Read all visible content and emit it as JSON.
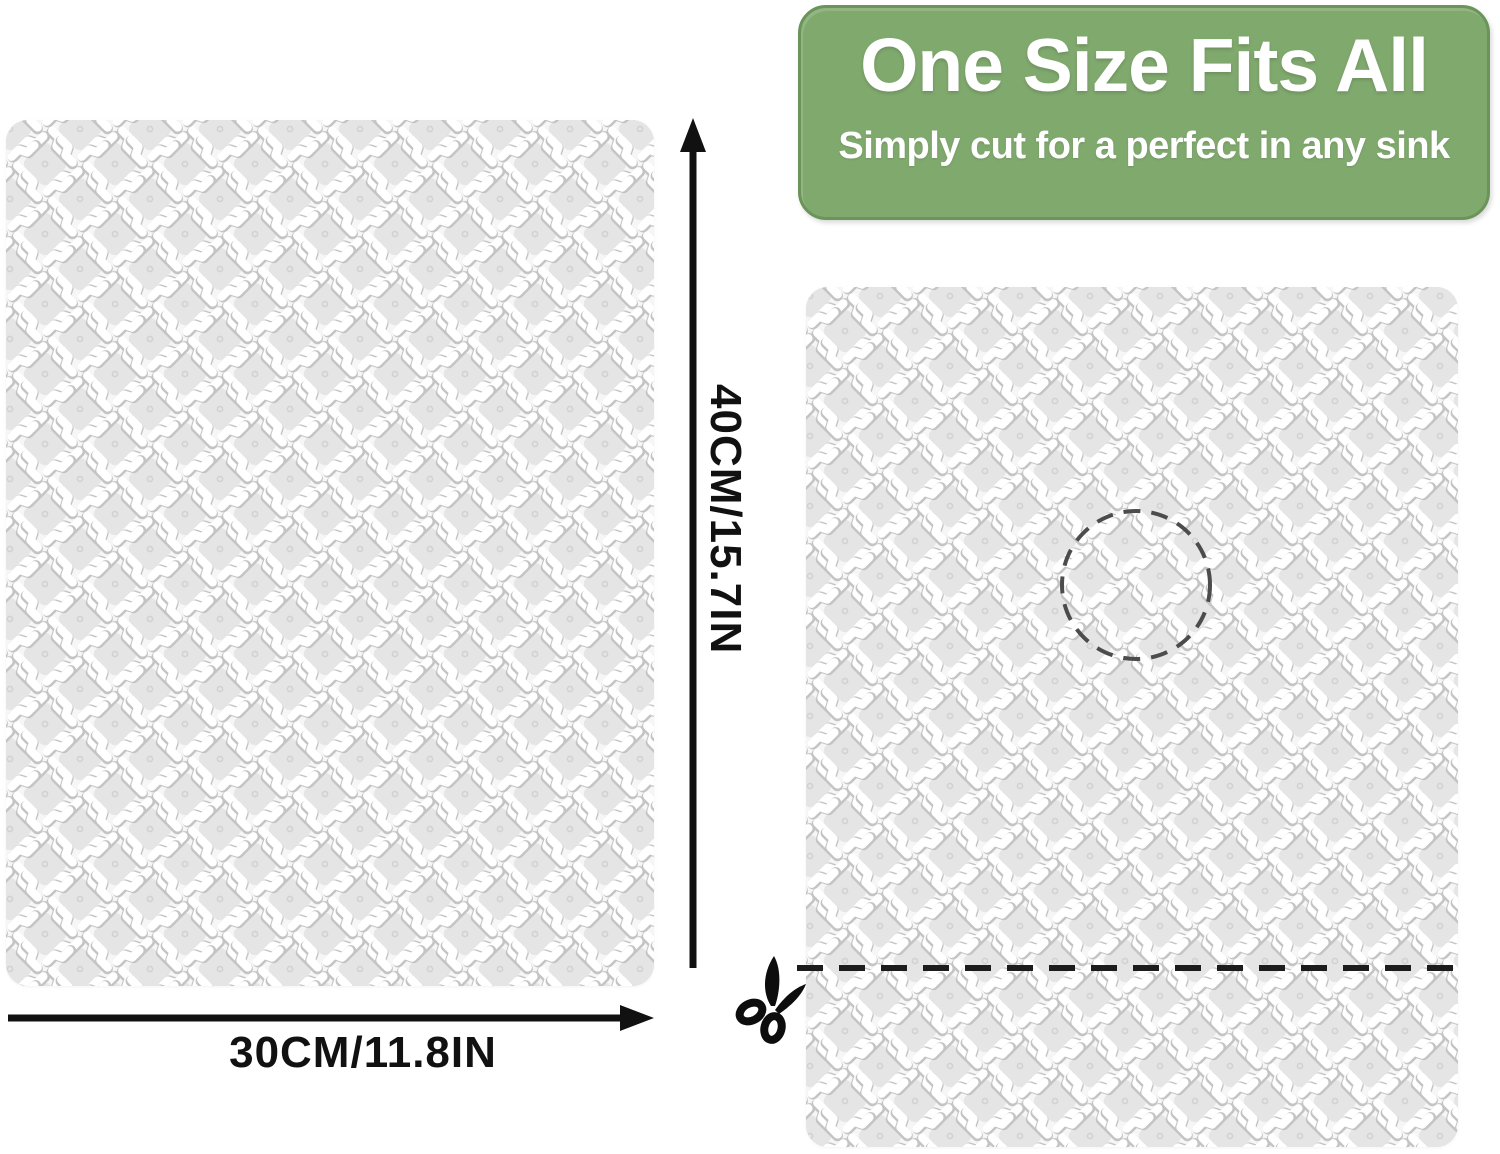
{
  "banner": {
    "title": "One Size Fits All",
    "subtitle": "Simply cut for a perfect in any sink"
  },
  "dimensions": {
    "height_label": "40CM/15.7IN",
    "width_label": "30CM/11.8IN"
  },
  "icons": {
    "scissors": "scissors-icon",
    "drain_circle": "drain-cutout-dashed-circle",
    "cut_line": "dashed-cut-line"
  },
  "colors": {
    "banner_green": "#80a96e",
    "banner_border": "#6a9459",
    "banner_text": "#ffffff",
    "arrow_black": "#111111",
    "dash_line": "#1c1c1c",
    "drain_circle_dash": "#4c4c4c",
    "mat_bg": "#fbfbfb",
    "mat_border": "#dddddd",
    "mat_diamond": "#e5e5e5",
    "mat_bone_shadow": "#c4c4c4"
  }
}
